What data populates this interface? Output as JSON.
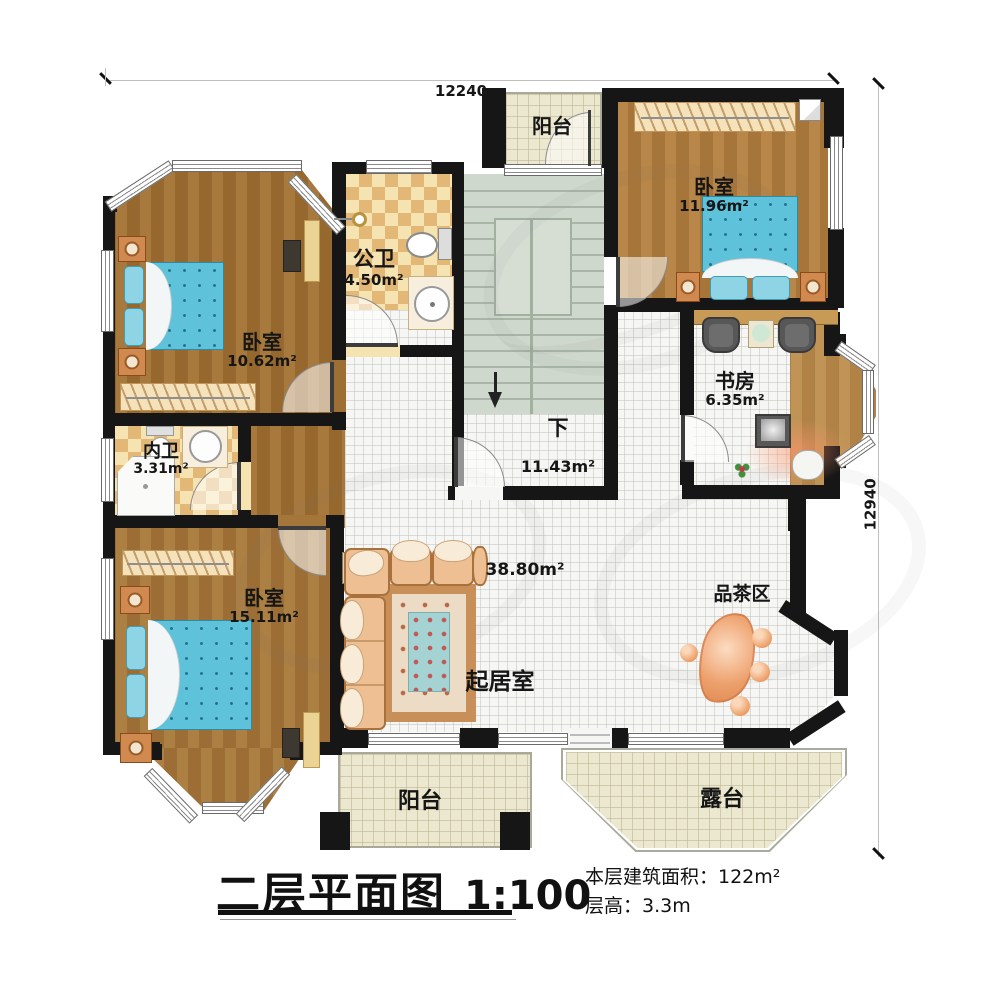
{
  "dimensions": {
    "top": "12240",
    "right": "12940"
  },
  "titleblock": {
    "title": "二层平面图",
    "scale": "1:100",
    "area_line": "本层建筑面积：122m²",
    "height_line": "层高：3.3m"
  },
  "rooms": {
    "balcony_top": {
      "name": "阳台"
    },
    "bedroom_top_right": {
      "name": "卧室",
      "area": "11.96m²"
    },
    "public_bath": {
      "name": "公卫",
      "area": "4.50m²"
    },
    "bedroom_left": {
      "name": "卧室",
      "area": "10.62m²"
    },
    "study": {
      "name": "书房",
      "area": "6.35m²"
    },
    "inner_bath": {
      "name": "内卫",
      "area": "3.31m²"
    },
    "bedroom_bottom_left": {
      "name": "卧室",
      "area": "15.11m²"
    },
    "stairs": {
      "name": "下",
      "area": "11.43m²"
    },
    "living": {
      "name": "起居室",
      "area": "38.80m²"
    },
    "tea_area": {
      "name": "品茶区"
    },
    "balcony_bottom": {
      "name": "阳台"
    },
    "terrace": {
      "name": "露台"
    }
  }
}
